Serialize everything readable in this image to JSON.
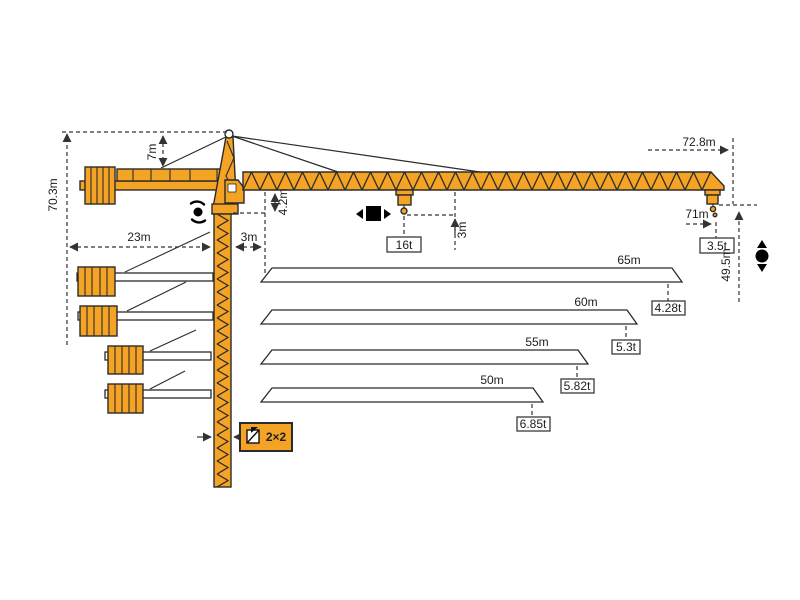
{
  "diagram_title": "tower-crane-dimension-diagram",
  "colors": {
    "crane_orange": "#F5A324",
    "outline": "#2B2B2B",
    "dimension": "#333333",
    "background": "#FFFFFF"
  },
  "dim_labels": {
    "total_height": "70.3m",
    "head_height": "7m",
    "counter_jib_radius": "23m",
    "jib_root_offset": "3m",
    "jib_section_depth": "4.2m",
    "hook_drop": "3m",
    "max_radius": "72.8m",
    "tip_hook_radius": "71m",
    "hook_height": "49.5m",
    "mast_section": "2×2"
  },
  "loads": {
    "max_capacity": "16t",
    "tip_capacity": "3.5t"
  },
  "jib_options": [
    {
      "length": "65m",
      "tip_capacity": "4.28t"
    },
    {
      "length": "60m",
      "tip_capacity": "5.3t"
    },
    {
      "length": "55m",
      "tip_capacity": "5.82t"
    },
    {
      "length": "50m",
      "tip_capacity": "6.85t"
    }
  ],
  "icons": {
    "slewing": "slewing-rotation-icon",
    "trolley": "trolley-travel-icon",
    "hoist": "hoist-up-down-icon",
    "mast_section": "mast-cross-section-icon"
  }
}
